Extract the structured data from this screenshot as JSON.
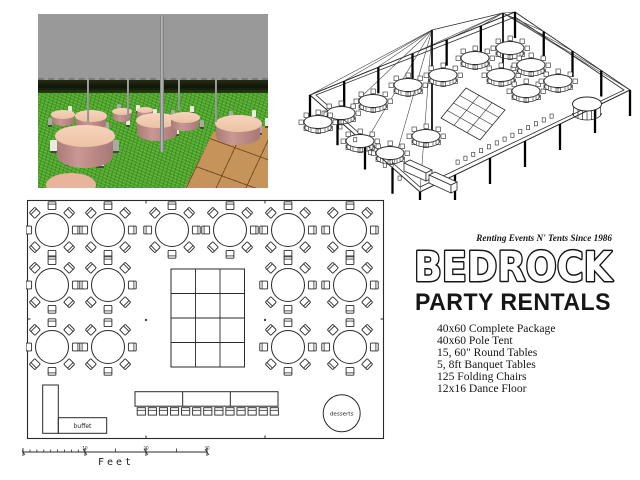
{
  "logo": {
    "tagline": "Renting Events N' Tents Since 1986",
    "name": "BEDROCK",
    "subtitle": "PARTY RENTALS"
  },
  "package_list": {
    "items": [
      "40x60 Complete Package",
      "40x60 Pole Tent",
      "15, 60\" Round Tables",
      "5, 8ft Banquet Tables",
      "125 Folding Chairs",
      "12x16 Dance Floor"
    ]
  },
  "floor_plan": {
    "buffet_label": "buffet",
    "desserts_label": "desserts",
    "scale_bar": {
      "unit_label": "Feet",
      "tick_labels": [
        "10",
        "20",
        "30"
      ]
    },
    "round_tables": {
      "chairs_per_table": 8,
      "table_radius": 16.5,
      "columns_x": [
        26,
        82,
        146,
        204,
        262,
        324
      ],
      "rows": [
        {
          "y": 31,
          "cols": [
            0,
            1,
            2,
            3,
            4,
            5
          ]
        },
        {
          "y": 86,
          "cols": [
            0,
            1,
            4,
            5
          ]
        },
        {
          "y": 148,
          "cols": [
            0,
            1,
            4,
            5
          ]
        }
      ]
    },
    "dance_floor": {
      "x": 145,
      "y": 70,
      "width": 73.5,
      "height": 98,
      "cols": 3,
      "rows": 4
    },
    "banquet_row": {
      "x": 109,
      "y": 192.7,
      "width": 143,
      "height": 14.5,
      "sections": 3,
      "chairs": 13
    }
  },
  "colors": {
    "line_ink": "#2a2a2a",
    "grass_green": "#4aa22c",
    "tent_ceiling_gray": "#999999",
    "table_top_peach": "#f2c9ae",
    "table_skirt_rose": "#bd8b89",
    "dance_floor_wood": "#c6945a",
    "logo_ink": "#161616"
  }
}
